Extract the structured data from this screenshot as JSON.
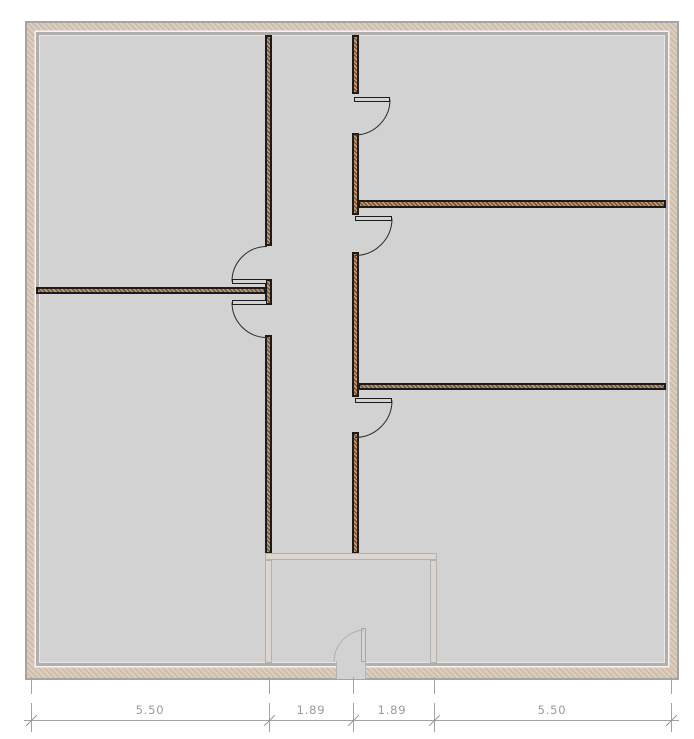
{
  "plan": {
    "type": "floor-plan",
    "colors": {
      "floor": "#d2d2d2",
      "outer_wall_fill": "#d5c6b8",
      "outer_wall_stroke": "#a7a3a1",
      "interior_wall_light": "#c49c72",
      "interior_wall_dark": "#7a4f2e",
      "wall_outline": "#1b1b1b",
      "ghost_layer": "#b3b0ad",
      "dimension": "#9a9a9a"
    },
    "dimensions": {
      "unit": "m",
      "values_m": [
        5.5,
        1.89,
        1.89,
        5.5
      ],
      "labels": [
        {
          "label": "5.50"
        },
        {
          "label": "1.89"
        },
        {
          "label": "1.89"
        },
        {
          "label": "5.50"
        }
      ]
    }
  }
}
